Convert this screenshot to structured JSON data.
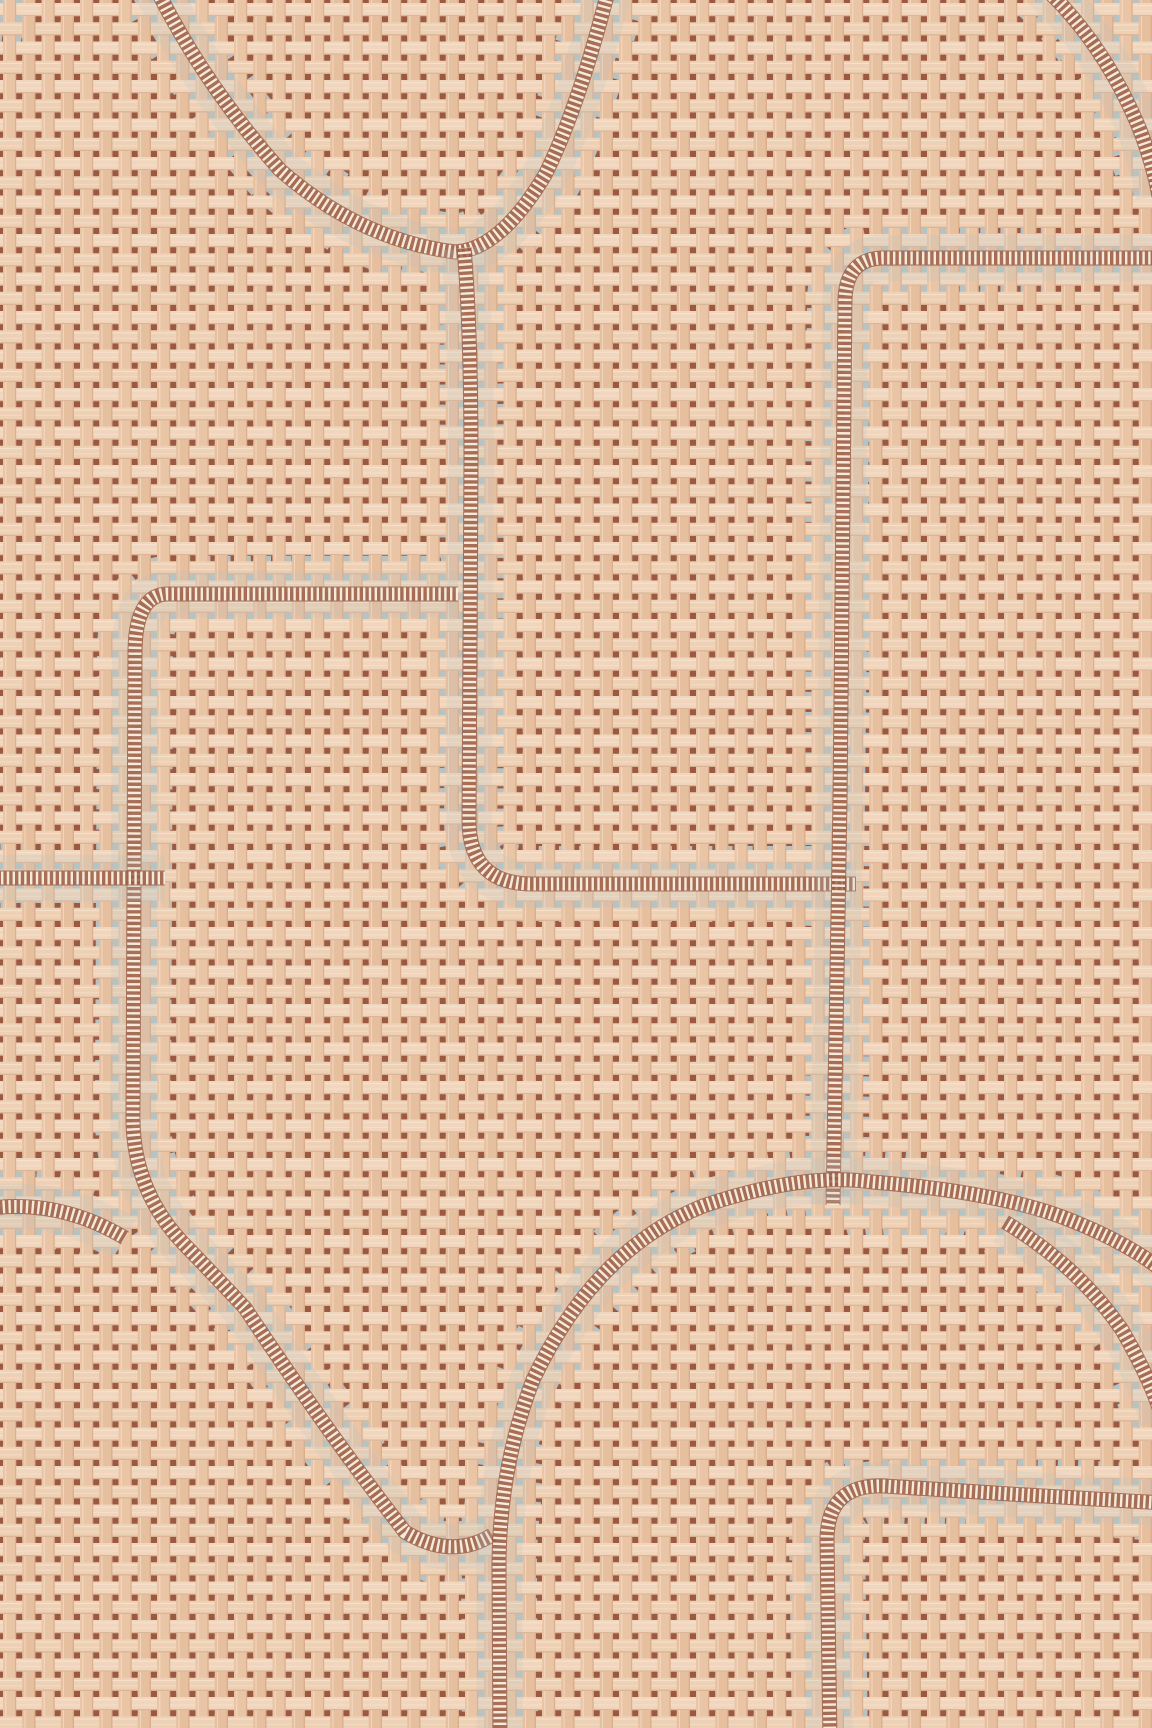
{
  "scene": {
    "description": "paperweave-grasscloth-wallpaper-swatch-terracotta-with-gray-fretwork-of-rectangles-and-circles",
    "width": 1152,
    "height": 1728
  },
  "palette": {
    "ground_brown": "#9c5942",
    "thread_light": "#f1d6bd",
    "thread_light2": "#eed0b4",
    "thread_mid": "#e9c5a6",
    "thread_mid2": "#e6bf9f",
    "thread_highlight": "#f9ecdc",
    "thread_shadow": "#c6906f",
    "motif_gray": "#b5c3c5",
    "stitch_base": "#9a5740",
    "stitch_tick": "#f6ebdb"
  },
  "weave": {
    "pitch": 38.5,
    "bar": 13.2,
    "offset": 3.0
  },
  "motif": {
    "core_width": 50,
    "teeth_width": 76,
    "teeth_dash": "12 8.2",
    "tint_width": 46,
    "tint_opacity": 0.2,
    "zip_base_width": 15,
    "zip_base_opacity": 0.8,
    "zip_tick_width": 13,
    "zip_tick_dash": "2.4 3.4",
    "bands": [
      {
        "id": "top-bowl-arc",
        "type": "band",
        "d": "M 150,-24 Q 200,80 280,170 Q 360,240 455,252 Q 500,250 545,175 Q 580,105 612,-24"
      },
      {
        "id": "left-vertical-to-middle-horizontal",
        "type": "band",
        "d": "M 464,248 Q 471,330 471,460 L 469,820 Q 469,884 532,884 L 856,884"
      },
      {
        "id": "topright-horizontal-and-long-vertical",
        "type": "band",
        "d": "M 1164,258 L 884,258 Q 846,258 845,300 L 840,800 L 833,1205"
      },
      {
        "id": "left-rectangle-and-diagonal-sweep",
        "type": "band",
        "d": "M 458,594 L 168,594 Q 136,594 135,650 L 133,1115 Q 132,1188 182,1242 Q 215,1276 245,1308 Q 330,1436 405,1532 Q 452,1560 492,1535"
      },
      {
        "id": "left-edge-stub",
        "type": "band",
        "d": "M -20,878 L 165,878"
      },
      {
        "id": "lower-left-edge-stub",
        "type": "band",
        "d": "M -22,1210 Q 55,1196 125,1238"
      },
      {
        "id": "big-circle-arc-with-tail",
        "type": "band",
        "d": "M 500,1742 L 499,1568 Q 499,1468 533,1380 Q 594,1250 703,1206 Q 803,1172 872,1182 Q 1000,1192 1070,1220 Q 1130,1244 1164,1272"
      },
      {
        "id": "right-branch-arc",
        "type": "band",
        "d": "M 1005,1222 Q 1078,1266 1122,1330 Q 1152,1382 1163,1420"
      },
      {
        "id": "bottomright-rectangle",
        "type": "band",
        "d": "M 830,1742 L 827,1540 Q 827,1484 884,1486 L 1010,1494 L 1164,1503"
      },
      {
        "id": "topright-corner-wedge",
        "type": "wedge",
        "d": "M 1045,-12 Q 1105,45 1140,130 Q 1154,168 1159,196",
        "fill": "M 1043,-14 Q 1104,44 1139,129 Q 1153,167 1158,194 L 1164,200 L 1164,-14 Z"
      },
      {
        "id": "apex-junction-filler",
        "type": "blob",
        "d": "M 830,1208 Q 918,1182 1002,1218"
      },
      {
        "id": "right-edge-filler",
        "type": "blob",
        "d": "M 1085,1272 Q 1125,1312 1160,1352"
      },
      {
        "id": "topleft-corner-chip",
        "type": "blob",
        "d": "M -26,6 Q 0,8 30,14"
      }
    ]
  }
}
